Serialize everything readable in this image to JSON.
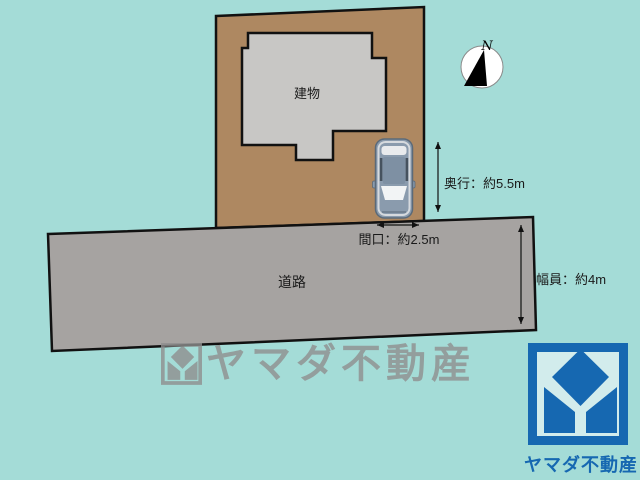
{
  "diagram": {
    "building_label": "建物",
    "road_label": "道路",
    "compass_label": "N",
    "dimensions": {
      "depth": "奥行：約5.5m",
      "frontage": "間口：約2.5m",
      "road_width": "幅員：約4m"
    },
    "watermark_text": "ヤマダ不動産",
    "logo_text": "ヤマダ不動産",
    "icons": {
      "compass": "north-arrow-compass",
      "car": "car-top-view",
      "logo_mark": "yamada-diamond-square-mark"
    },
    "colors": {
      "background": "#a4dcd7",
      "lot": "#ae8861",
      "building": "#c8c7c5",
      "road": "#a6a3a1",
      "outline": "#111111",
      "logo_blue": "#1668b1",
      "logo_inner": "#d2ecec",
      "watermark_gray": "#8f8f8f",
      "car_body": "#8a9bad"
    }
  }
}
